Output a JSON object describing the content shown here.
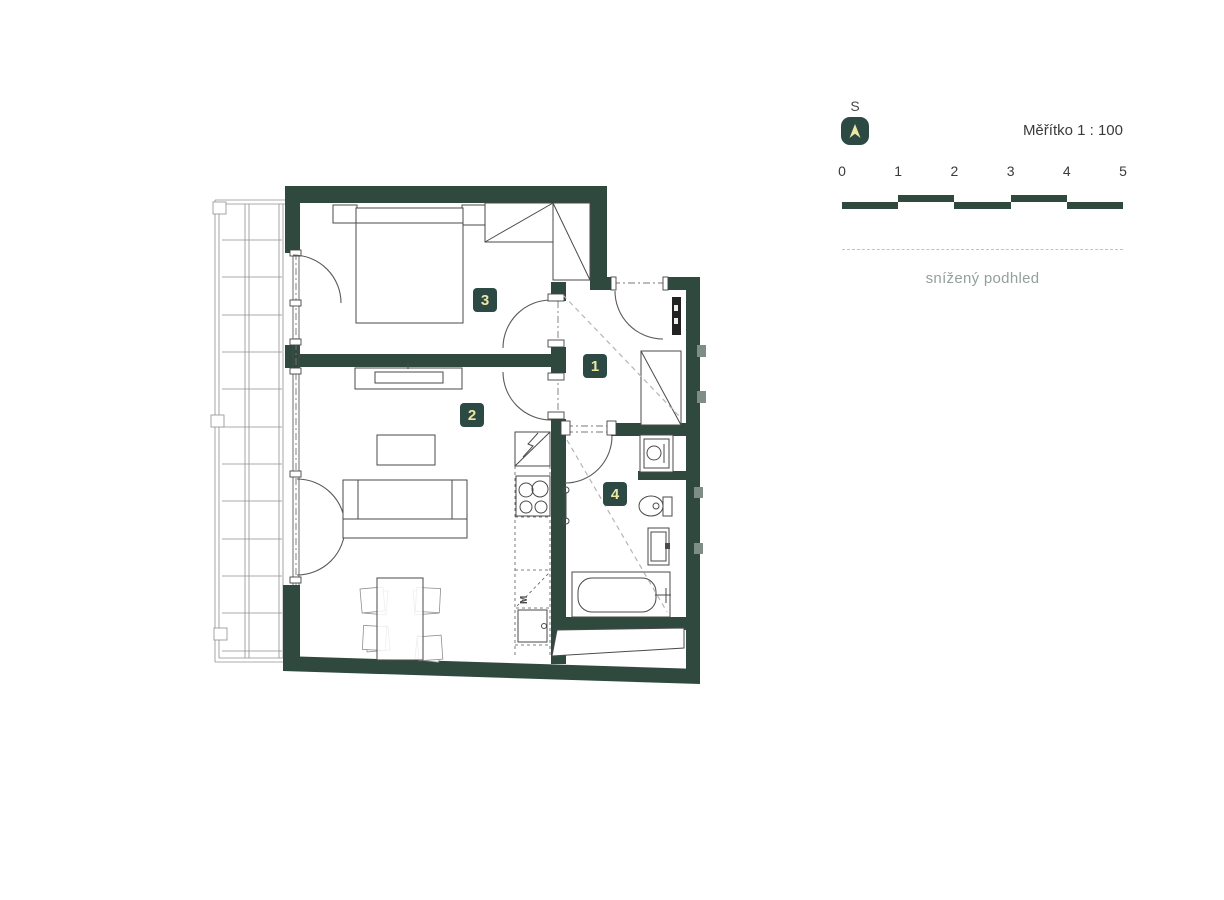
{
  "legend": {
    "north_label": "S",
    "scale_label": "Měřítko 1 : 100",
    "scale_ticks": [
      "0",
      "1",
      "2",
      "3",
      "4",
      "5"
    ],
    "lowered_ceiling_note": "snížený podhled"
  },
  "rooms": [
    {
      "number": "1"
    },
    {
      "number": "2"
    },
    {
      "number": "3"
    },
    {
      "number": "4"
    }
  ],
  "kitchen": {
    "dishwasher_label": "M"
  },
  "colors": {
    "wall": "#30493F",
    "badge": "#2C4A43",
    "badge_text": "#EBE8A4",
    "note_text": "#93A09B",
    "line": "#4A4A4A"
  }
}
